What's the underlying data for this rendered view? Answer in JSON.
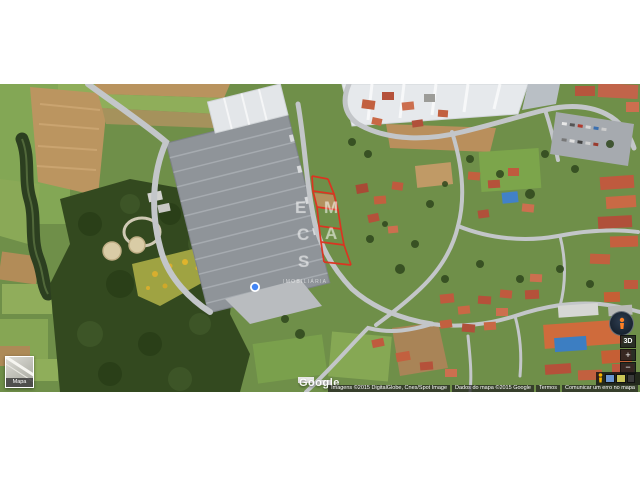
{
  "canvas": {
    "width": 640,
    "height": 480,
    "background": "#ffffff"
  },
  "map": {
    "plot_outline_color": "#e0311f",
    "marker_color": "#4285f4",
    "watermark": {
      "letters": [
        "E",
        "M",
        "C",
        "A",
        "S"
      ],
      "caption": "IMOBILIÁRIA"
    },
    "controls": {
      "threed": "3D",
      "zoom_in": "+",
      "zoom_out": "−"
    },
    "inset": {
      "label": "Mapa"
    },
    "logo": "Google",
    "attribution": [
      "Imagens ©2015 DigitalGlobe, Cnes/Spot Image",
      "Dados do mapa ©2015 Google",
      "Termos",
      "Comunicar um erro no mapa"
    ]
  }
}
